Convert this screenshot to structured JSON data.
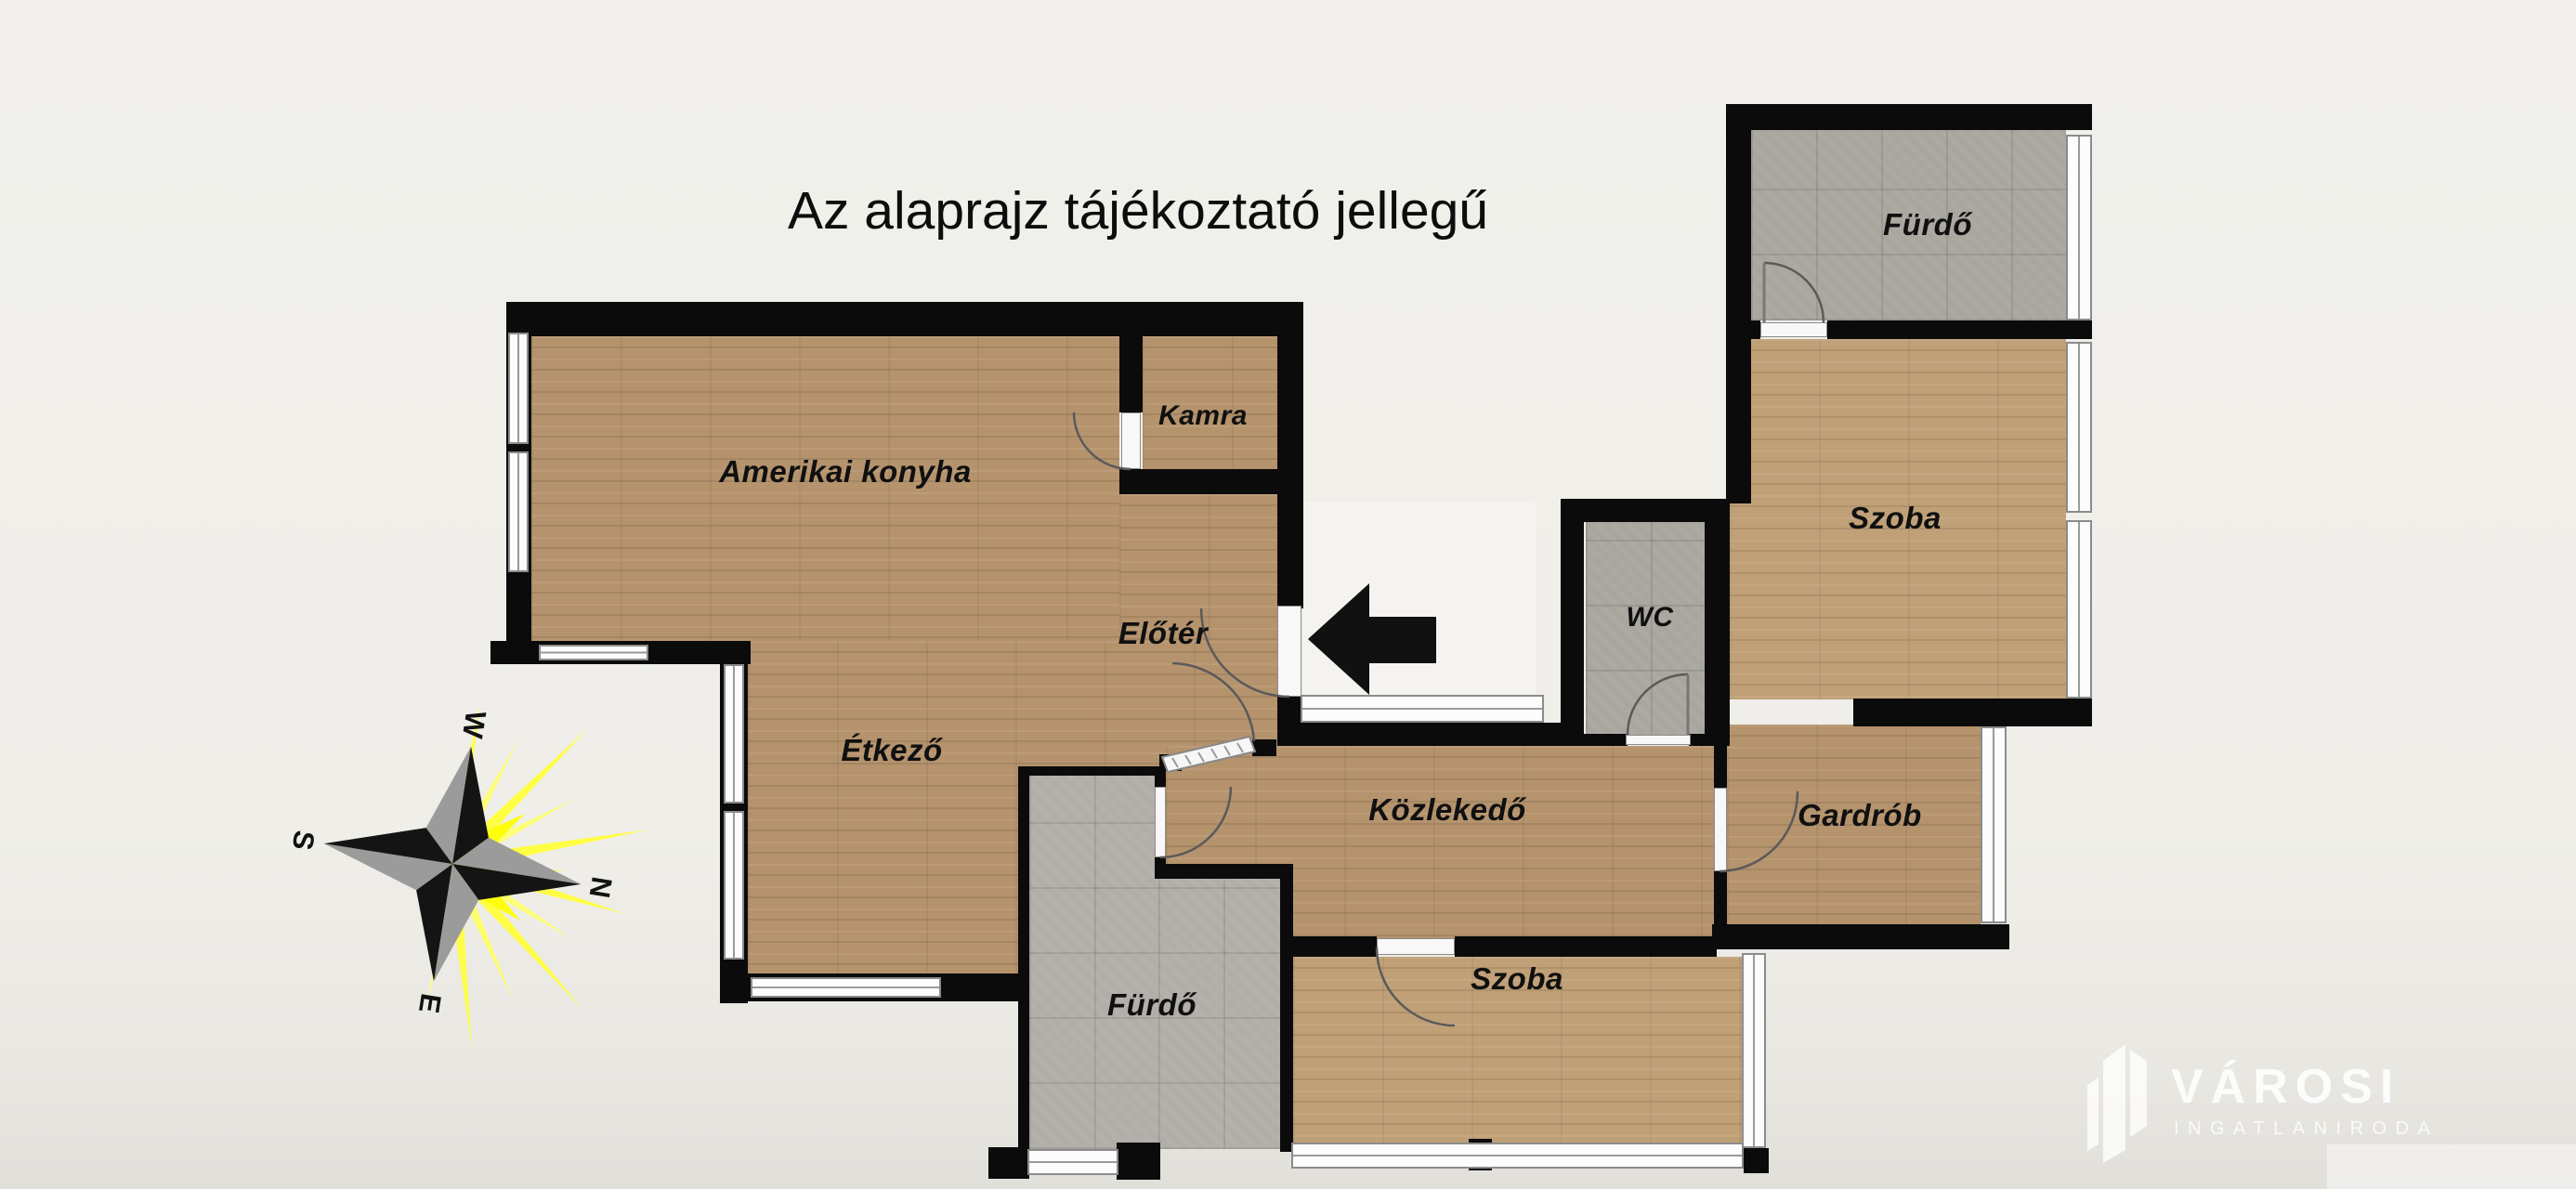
{
  "title": "Az alaprajz tájékoztató jellegű",
  "rooms": {
    "konyha": {
      "label": "Amerikai konyha"
    },
    "kamra": {
      "label": "Kamra"
    },
    "eloter": {
      "label": "Előtér"
    },
    "etkezo": {
      "label": "Étkező"
    },
    "furdo_felso": {
      "label": "Fürdő"
    },
    "szoba_felso": {
      "label": "Szoba"
    },
    "wc": {
      "label": "WC"
    },
    "kozlekedo": {
      "label": "Közlekedő"
    },
    "gardrob": {
      "label": "Gardrób"
    },
    "furdo_also": {
      "label": "Fürdő"
    },
    "szoba_also": {
      "label": "Szoba"
    }
  },
  "compass": {
    "n": "N",
    "s": "S",
    "e": "E",
    "w": "W"
  },
  "watermark": {
    "brand": "VÁROSI",
    "tagline": "INGATLANIRODA"
  },
  "colors": {
    "wall": "#0b0b0b",
    "wood_floor": "#b5936d",
    "wood_floor_light": "#c0a077",
    "tile_floor": "#a9a69f",
    "sun_yellow": "#ffff3d",
    "background": "#efeee9"
  }
}
